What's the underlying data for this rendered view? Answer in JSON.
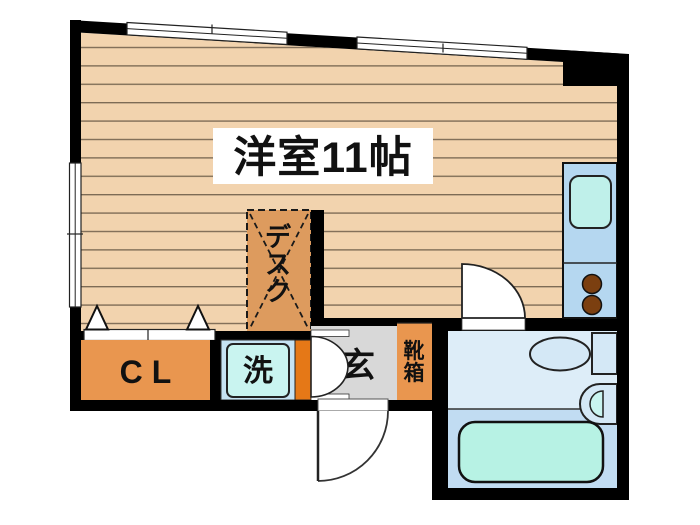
{
  "title": "洋室11帖",
  "labels": {
    "main_room": "洋室11帖",
    "desk": "デスク",
    "closet": "CL",
    "washer": "洗",
    "entrance": "玄",
    "shoe_box": "靴箱"
  },
  "colors": {
    "wall": "#000000",
    "floor_base": "#f2d3ae",
    "floor_line": "#7d6b55",
    "desk": "#dd9b5e",
    "closet": "#e9964f",
    "shoe_box": "#e9964f",
    "washer_frame": "#c6e3f3",
    "washer_unit": "#c9f4f0",
    "accent_strip": "#e57817",
    "entrance_floor": "#d8d8d8",
    "kitchen": "#b5d7f0",
    "kitchen_sink": "#bff0ea",
    "burner": "#7b3f10",
    "bath_upper": "#ddedf8",
    "bath_lower": "#c1dcf2",
    "bathtub": "#b7f2e4",
    "fixture": "#d4e8f6",
    "door": "#ffffff"
  }
}
